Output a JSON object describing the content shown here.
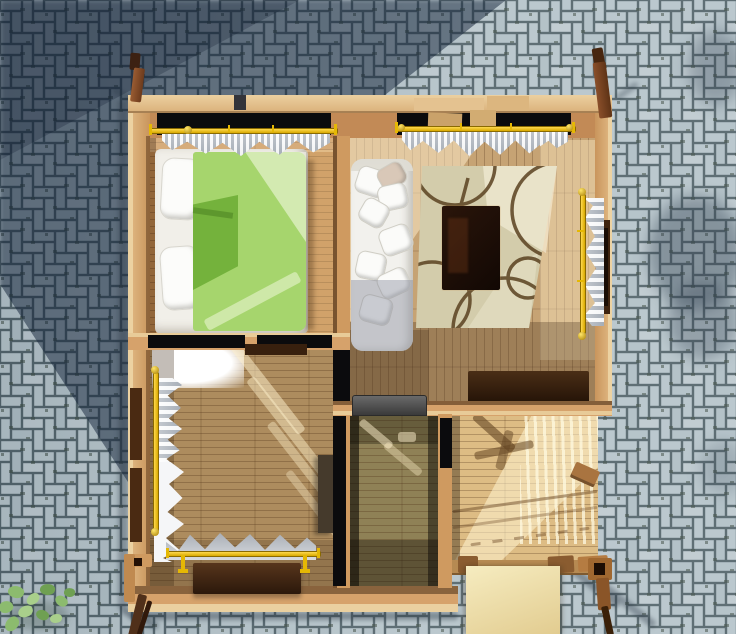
{
  "scene": {
    "type": "3d-architectural-render",
    "view": "top-down cutaway of a small square wooden house on a paved yard",
    "ground": {
      "pattern": "herringbone-pavers",
      "paver_light": "#b6c4ca",
      "paver_joint": "#50626a",
      "moss_tint": "#3c4a41",
      "large_shadow_tint": "rgba(17,33,55,0.5)",
      "shadow_area": "upper-left diagonal band"
    },
    "house": {
      "wall_color": "#d6a26b",
      "wall_top_plate": "#ecd0a0",
      "rooms": [
        {
          "name": "bedroom",
          "position": "top-left",
          "floor_color": "#c08a52",
          "furniture": [
            "double-bed",
            "green-duvet",
            "white-pillows"
          ]
        },
        {
          "name": "living-room",
          "position": "top-right",
          "floor_color": "#c6a374",
          "furniture": [
            "white-sofa",
            "patterned-rug",
            "dark-media-table",
            "dark-desk"
          ]
        },
        {
          "name": "second-room",
          "position": "bottom-left",
          "floor_color": "#ad8c5e",
          "furniture": [
            "wall-cabinet",
            "dark-table",
            "clothes-rail"
          ]
        },
        {
          "name": "hallway",
          "position": "bottom-center",
          "floor_color": "#8f8156",
          "furniture": [
            "stove"
          ]
        },
        {
          "name": "deck",
          "position": "bottom-right",
          "floor_color": "#ddbc84",
          "furniture": [
            "plywood-steps"
          ]
        }
      ],
      "windows": [
        {
          "wall": "top",
          "room": "bedroom",
          "curtain_color": "white",
          "rod_color": "#edc106"
        },
        {
          "wall": "top",
          "room": "living-room",
          "curtain_color": "white",
          "rod_color": "#edc106"
        },
        {
          "wall": "right",
          "room": "living-room",
          "curtain_color": "white",
          "rod_color": "#edc106"
        },
        {
          "wall": "left",
          "room": "second-room",
          "curtain_color": "white",
          "rod_color": "#edc106"
        },
        {
          "wall": "bottom",
          "room": "second-room",
          "curtain_color": "gray",
          "rod_color": "#edc106"
        }
      ],
      "corner_posts": 4,
      "bed_duvet_color": "#a6d56d",
      "rug_color": "#d3ccab",
      "rug_swirl_color": "#5a4120"
    },
    "vegetation": {
      "position": "bottom-left pavement",
      "leaf_colors": [
        "#8cbb6e",
        "#a9cf8b",
        "#6fa052"
      ]
    },
    "lighting": {
      "sun_from": "upper-right",
      "effects": [
        "sun streaks on floors",
        "railing shadows on deck",
        "tree shadow blobs on right pavement"
      ]
    }
  }
}
